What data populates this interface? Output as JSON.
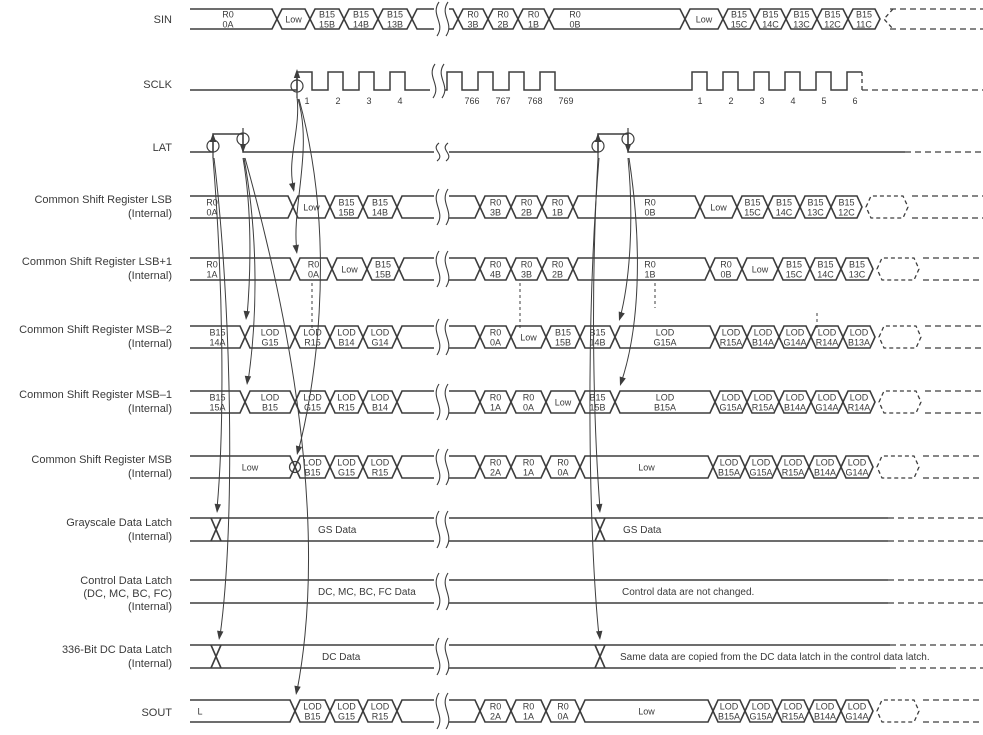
{
  "diagram": {
    "colors": {
      "line": "#3d3d3d",
      "text": "#3a3a3a",
      "background": "#ffffff"
    },
    "rows": [
      {
        "id": "sin",
        "type": "bus",
        "label": [
          "SIN"
        ],
        "ly": [
          23
        ],
        "top": 9,
        "bot": 29,
        "break_x": 437,
        "cells": [
          {
            "x0": 190,
            "x1": 277,
            "t": "R0|0A",
            "lx": 228
          },
          {
            "x0": 277,
            "x1": 310,
            "t": "Low"
          },
          {
            "x0": 310,
            "x1": 344,
            "t": "B15|15B"
          },
          {
            "x0": 344,
            "x1": 378,
            "t": "B15|14B"
          },
          {
            "x0": 378,
            "x1": 412,
            "t": "B15|13B"
          },
          {
            "x0": 412,
            "x1": 458,
            "t": ""
          },
          {
            "x0": 458,
            "x1": 488,
            "t": "R0|3B"
          },
          {
            "x0": 488,
            "x1": 518,
            "t": "R0|2B"
          },
          {
            "x0": 518,
            "x1": 549,
            "t": "R0|1B"
          },
          {
            "x0": 549,
            "x1": 685,
            "t": "R0|0B",
            "lx": 575
          },
          {
            "x0": 685,
            "x1": 723,
            "t": "Low"
          },
          {
            "x0": 723,
            "x1": 755,
            "t": "B15|15C"
          },
          {
            "x0": 755,
            "x1": 786,
            "t": "B15|14C"
          },
          {
            "x0": 786,
            "x1": 817,
            "t": "B15|13C"
          },
          {
            "x0": 817,
            "x1": 848,
            "t": "B15|12C"
          },
          {
            "x0": 848,
            "x1": 880,
            "t": "B15|11C"
          }
        ],
        "dash": {
          "from": 884,
          "cell": false,
          "chevron": true
        }
      },
      {
        "id": "sclk",
        "type": "clock",
        "label": [
          "SCLK"
        ],
        "ly": [
          88
        ],
        "base": 90,
        "high": 72,
        "start": 190,
        "high_w": 15,
        "break_x": 433,
        "num_y": 104,
        "pulses": [
          {
            "x": 297,
            "n": "1",
            "nx": 307
          },
          {
            "x": 328,
            "n": "2",
            "nx": 338
          },
          {
            "x": 359,
            "n": "3",
            "nx": 369
          },
          {
            "x": 390,
            "n": "4",
            "nx": 400
          },
          {
            "x": 447,
            "n": "766",
            "nx": 472
          },
          {
            "x": 478,
            "n": "767",
            "nx": 503
          },
          {
            "x": 509,
            "n": "768",
            "nx": 535
          },
          {
            "x": 540,
            "n": "769",
            "nx": 566
          },
          {
            "x": 692,
            "n": "1",
            "nx": 700
          },
          {
            "x": 723,
            "n": "2",
            "nx": 731
          },
          {
            "x": 754,
            "n": "3",
            "nx": 762
          },
          {
            "x": 785,
            "n": "4",
            "nx": 793
          },
          {
            "x": 816,
            "n": "5",
            "nx": 824
          },
          {
            "x": 847,
            "n": "6",
            "nx": 855
          }
        ],
        "marker": {
          "x": 297,
          "circle_y": 86,
          "stem_y0": 98,
          "tip_y": 69
        }
      },
      {
        "id": "lat",
        "type": "pulse",
        "label": [
          "LAT"
        ],
        "ly": [
          151
        ],
        "base": 152,
        "high": 134,
        "break_x": 437,
        "solid_to": 905,
        "pulses": [
          {
            "rise": 213,
            "fall": 243
          },
          {
            "rise": 598,
            "fall": 628
          }
        ]
      },
      {
        "id": "csr-lsb",
        "type": "bus",
        "label": [
          "Common Shift Register LSB",
          "(Internal)"
        ],
        "ly": [
          203,
          217
        ],
        "top": 196,
        "bot": 218,
        "break_x": 437,
        "cells": [
          {
            "x0": 190,
            "x1": 293,
            "t": "R0|0A",
            "lx": 212
          },
          {
            "x0": 293,
            "x1": 330,
            "t": "Low"
          },
          {
            "x0": 330,
            "x1": 363,
            "t": "B15|15B"
          },
          {
            "x0": 363,
            "x1": 397,
            "t": "B15|14B"
          },
          {
            "x0": 397,
            "x1": 480,
            "t": ""
          },
          {
            "x0": 480,
            "x1": 511,
            "t": "R0|3B"
          },
          {
            "x0": 511,
            "x1": 542,
            "t": "R0|2B"
          },
          {
            "x0": 542,
            "x1": 573,
            "t": "R0|1B"
          },
          {
            "x0": 573,
            "x1": 700,
            "t": "R0|0B",
            "lx": 650
          },
          {
            "x0": 700,
            "x1": 737,
            "t": "Low"
          },
          {
            "x0": 737,
            "x1": 768,
            "t": "B15|15C"
          },
          {
            "x0": 768,
            "x1": 800,
            "t": "B15|14C"
          },
          {
            "x0": 800,
            "x1": 831,
            "t": "B15|13C"
          },
          {
            "x0": 831,
            "x1": 862,
            "t": "B15|12C"
          }
        ],
        "dash": {
          "from": 866,
          "cell": true,
          "chevron": false
        }
      },
      {
        "id": "csr-lsb1",
        "type": "bus",
        "label": [
          "Common Shift Register LSB+1",
          "(Internal)"
        ],
        "ly": [
          265,
          279
        ],
        "top": 258,
        "bot": 280,
        "break_x": 437,
        "cells": [
          {
            "x0": 190,
            "x1": 295,
            "t": "R0|1A",
            "lx": 212
          },
          {
            "x0": 295,
            "x1": 332,
            "t": "R0|0A"
          },
          {
            "x0": 332,
            "x1": 367,
            "t": "Low"
          },
          {
            "x0": 367,
            "x1": 399,
            "t": "B15|15B"
          },
          {
            "x0": 399,
            "x1": 480,
            "t": ""
          },
          {
            "x0": 480,
            "x1": 511,
            "t": "R0|4B"
          },
          {
            "x0": 511,
            "x1": 542,
            "t": "R0|3B"
          },
          {
            "x0": 542,
            "x1": 573,
            "t": "R0|2B"
          },
          {
            "x0": 573,
            "x1": 710,
            "t": "R0|1B",
            "lx": 650
          },
          {
            "x0": 710,
            "x1": 742,
            "t": "R0|0B"
          },
          {
            "x0": 742,
            "x1": 778,
            "t": "Low"
          },
          {
            "x0": 778,
            "x1": 810,
            "t": "B15|15C"
          },
          {
            "x0": 810,
            "x1": 841,
            "t": "B15|14C"
          },
          {
            "x0": 841,
            "x1": 873,
            "t": "B15|13C"
          }
        ],
        "dash": {
          "from": 877,
          "cell": true,
          "chevron": false
        }
      },
      {
        "id": "csr-msb2",
        "type": "bus",
        "label": [
          "Common Shift  Register MSB–2",
          "(Internal)"
        ],
        "ly": [
          333,
          347
        ],
        "top": 326,
        "bot": 348,
        "break_x": 437,
        "cells": [
          {
            "x0": 190,
            "x1": 245,
            "t": "B15|14A"
          },
          {
            "x0": 245,
            "x1": 295,
            "t": "LOD|G15"
          },
          {
            "x0": 295,
            "x1": 330,
            "t": "LOD|R15"
          },
          {
            "x0": 330,
            "x1": 363,
            "t": "LOD|B14"
          },
          {
            "x0": 363,
            "x1": 397,
            "t": "LOD|G14"
          },
          {
            "x0": 397,
            "x1": 480,
            "t": ""
          },
          {
            "x0": 480,
            "x1": 511,
            "t": "R0|0A"
          },
          {
            "x0": 511,
            "x1": 546,
            "t": "Low"
          },
          {
            "x0": 546,
            "x1": 580,
            "t": "B15|15B"
          },
          {
            "x0": 580,
            "x1": 615,
            "t": "B15|14B"
          },
          {
            "x0": 615,
            "x1": 715,
            "t": "LOD|G15A"
          },
          {
            "x0": 715,
            "x1": 747,
            "t": "LOD|R15A"
          },
          {
            "x0": 747,
            "x1": 779,
            "t": "LOD|B14A"
          },
          {
            "x0": 779,
            "x1": 811,
            "t": "LOD|G14A"
          },
          {
            "x0": 811,
            "x1": 843,
            "t": "LOD|R14A"
          },
          {
            "x0": 843,
            "x1": 875,
            "t": "LOD|B13A"
          }
        ],
        "dash": {
          "from": 879,
          "cell": true,
          "chevron": false
        }
      },
      {
        "id": "csr-msb1",
        "type": "bus",
        "label": [
          "Common Shift Register MSB–1",
          "(Internal)"
        ],
        "ly": [
          398,
          412
        ],
        "top": 391,
        "bot": 413,
        "break_x": 437,
        "cells": [
          {
            "x0": 190,
            "x1": 245,
            "t": "B15|15A"
          },
          {
            "x0": 245,
            "x1": 295,
            "t": "LOD|B15"
          },
          {
            "x0": 295,
            "x1": 330,
            "t": "LOD|G15"
          },
          {
            "x0": 330,
            "x1": 363,
            "t": "LOD|R15"
          },
          {
            "x0": 363,
            "x1": 397,
            "t": "LOD|B14"
          },
          {
            "x0": 397,
            "x1": 480,
            "t": ""
          },
          {
            "x0": 480,
            "x1": 511,
            "t": "R0|1A"
          },
          {
            "x0": 511,
            "x1": 546,
            "t": "R0|0A"
          },
          {
            "x0": 546,
            "x1": 580,
            "t": "Low"
          },
          {
            "x0": 580,
            "x1": 615,
            "t": "B15|15B"
          },
          {
            "x0": 615,
            "x1": 715,
            "t": "LOD|B15A"
          },
          {
            "x0": 715,
            "x1": 747,
            "t": "LOD|G15A"
          },
          {
            "x0": 747,
            "x1": 779,
            "t": "LOD|R15A"
          },
          {
            "x0": 779,
            "x1": 811,
            "t": "LOD|B14A"
          },
          {
            "x0": 811,
            "x1": 843,
            "t": "LOD|G14A"
          },
          {
            "x0": 843,
            "x1": 875,
            "t": "LOD|R14A"
          }
        ],
        "dash": {
          "from": 879,
          "cell": true,
          "chevron": false
        }
      },
      {
        "id": "csr-msb",
        "type": "bus",
        "label": [
          "Common Shift Register MSB",
          "(Internal)"
        ],
        "ly": [
          463,
          477
        ],
        "top": 456,
        "bot": 478,
        "break_x": 437,
        "cells": [
          {
            "x0": 190,
            "x1": 295,
            "t": "Low",
            "lx": 250
          },
          {
            "x0": 295,
            "x1": 330,
            "t": "LOD|B15"
          },
          {
            "x0": 330,
            "x1": 363,
            "t": "LOD|G15"
          },
          {
            "x0": 363,
            "x1": 397,
            "t": "LOD|R15"
          },
          {
            "x0": 397,
            "x1": 480,
            "t": ""
          },
          {
            "x0": 480,
            "x1": 511,
            "t": "R0|2A"
          },
          {
            "x0": 511,
            "x1": 546,
            "t": "R0|1A"
          },
          {
            "x0": 546,
            "x1": 580,
            "t": "R0|0A"
          },
          {
            "x0": 580,
            "x1": 713,
            "t": "Low"
          },
          {
            "x0": 713,
            "x1": 745,
            "t": "LOD|B15A"
          },
          {
            "x0": 745,
            "x1": 777,
            "t": "LOD|G15A"
          },
          {
            "x0": 777,
            "x1": 809,
            "t": "LOD|R15A"
          },
          {
            "x0": 809,
            "x1": 841,
            "t": "LOD|B14A"
          },
          {
            "x0": 841,
            "x1": 873,
            "t": "LOD|G14A"
          }
        ],
        "dash": {
          "from": 877,
          "cell": true,
          "chevron": false
        }
      },
      {
        "id": "gs-latch",
        "type": "latch",
        "label": [
          "Grayscale Data Latch",
          "(Internal)"
        ],
        "ly": [
          526,
          540
        ],
        "top": 518,
        "bot": 541,
        "break_x": 437,
        "xs": [
          216,
          600
        ],
        "texts": [
          {
            "x": 318,
            "s": "GS Data"
          },
          {
            "x": 623,
            "s": "GS Data"
          }
        ],
        "dash": {
          "from": 888,
          "cell": false,
          "chevron": false
        }
      },
      {
        "id": "ctrl-latch",
        "type": "latch",
        "label": [
          "Control Data Latch",
          "(DC, MC, BC, FC)",
          "(Internal)"
        ],
        "ly": [
          584,
          597,
          610
        ],
        "top": 580,
        "bot": 603,
        "break_x": 437,
        "xs": [],
        "texts": [
          {
            "x": 318,
            "s": "DC, MC, BC, FC Data"
          },
          {
            "x": 622,
            "s": "Control data are not changed."
          }
        ],
        "dash": {
          "from": 888,
          "cell": false,
          "chevron": false
        }
      },
      {
        "id": "dc-latch",
        "type": "latch",
        "label": [
          "336-Bit DC Data Latch",
          "(Internal)"
        ],
        "ly": [
          653,
          667
        ],
        "top": 645,
        "bot": 668,
        "break_x": 437,
        "xs": [
          216,
          600
        ],
        "texts": [
          {
            "x": 322,
            "s": "DC Data"
          },
          {
            "x": 620,
            "s": "Same data are copied from the DC data latch in the control data latch."
          }
        ],
        "dash": {
          "from": 890,
          "cell": false,
          "chevron": false
        }
      },
      {
        "id": "sout",
        "type": "bus",
        "label": [
          "SOUT"
        ],
        "ly": [
          716
        ],
        "top": 700,
        "bot": 722,
        "break_x": 437,
        "cells": [
          {
            "x0": 190,
            "x1": 295,
            "t": "L",
            "lx": 200
          },
          {
            "x0": 295,
            "x1": 330,
            "t": "LOD|B15"
          },
          {
            "x0": 330,
            "x1": 363,
            "t": "LOD|G15"
          },
          {
            "x0": 363,
            "x1": 397,
            "t": "LOD|R15"
          },
          {
            "x0": 397,
            "x1": 480,
            "t": ""
          },
          {
            "x0": 480,
            "x1": 511,
            "t": "R0|2A"
          },
          {
            "x0": 511,
            "x1": 546,
            "t": "R0|1A"
          },
          {
            "x0": 546,
            "x1": 580,
            "t": "R0|0A"
          },
          {
            "x0": 580,
            "x1": 713,
            "t": "Low"
          },
          {
            "x0": 713,
            "x1": 745,
            "t": "LOD|B15A"
          },
          {
            "x0": 745,
            "x1": 777,
            "t": "LOD|G15A"
          },
          {
            "x0": 777,
            "x1": 809,
            "t": "LOD|R15A"
          },
          {
            "x0": 809,
            "x1": 841,
            "t": "LOD|B14A"
          },
          {
            "x0": 841,
            "x1": 873,
            "t": "LOD|G14A"
          }
        ],
        "dash": {
          "from": 877,
          "cell": true,
          "chevron": false
        }
      }
    ],
    "arrows": [
      {
        "d": "M 297,97 C 301,130 286,160 294,190",
        "tip": [
          294,
          192
        ],
        "rot": 78
      },
      {
        "d": "M 298,99 C 313,150 291,210 297,251",
        "tip": [
          297,
          254
        ],
        "rot": 82
      },
      {
        "d": "M 299,99 C 340,250 312,400 298,452",
        "tip": [
          297,
          455
        ],
        "rot": 103
      },
      {
        "d": "M 213,158 C 223,280 225,420 217,509",
        "tip": [
          217,
          513
        ],
        "rot": 95
      },
      {
        "d": "M 214,158 C 231,300 236,520 220,636",
        "tip": [
          219,
          640
        ],
        "rot": 98
      },
      {
        "d": "M 243,158 C 252,210 251,270 247,317",
        "tip": [
          246,
          320
        ],
        "rot": 95
      },
      {
        "d": "M 244,158 C 259,240 257,320 248,382",
        "tip": [
          247,
          385
        ],
        "rot": 96
      },
      {
        "d": "M 245,158 C 307,380 322,560 297,691",
        "tip": [
          296,
          695
        ],
        "rot": 100
      },
      {
        "d": "M 598,158 C 590,300 594,430 600,509",
        "tip": [
          600,
          513
        ],
        "rot": 85
      },
      {
        "d": "M 599,158 C 585,330 589,540 599,636",
        "tip": [
          600,
          640
        ],
        "rot": 85
      },
      {
        "d": "M 628,158 C 634,220 630,280 620,318",
        "tip": [
          619,
          321
        ],
        "rot": 108
      },
      {
        "d": "M 629,158 C 643,250 639,330 621,383",
        "tip": [
          620,
          386
        ],
        "rot": 108
      }
    ],
    "extra_circles": [
      {
        "cx": 295,
        "cy": 467,
        "r": 5.5
      }
    ],
    "dashed_guides": [
      {
        "x": 312,
        "y0": 283,
        "y1": 331
      },
      {
        "x": 520,
        "y0": 283,
        "y1": 331
      },
      {
        "x": 655,
        "y0": 283,
        "y1": 308
      },
      {
        "x": 817,
        "y0": 313,
        "y1": 331
      }
    ]
  }
}
